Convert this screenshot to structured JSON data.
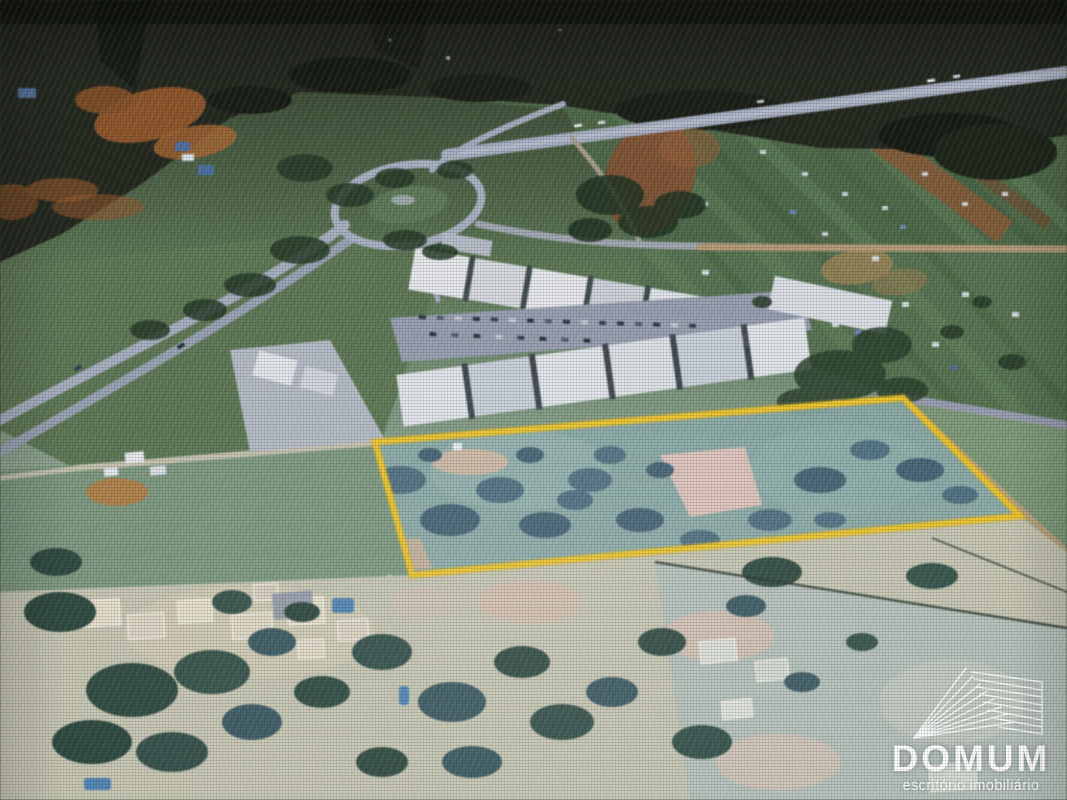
{
  "photo": {
    "description": "aerial satellite photo of a land parcel beside a highway roundabout and commercial strip",
    "annotation": {
      "parcel_points": "375,442 903,398 1020,516 412,575",
      "outline_color": "#f2c51e"
    }
  },
  "watermark": {
    "title": "DOMUM",
    "subtitle": "escritório imobiliário",
    "mark_icon": "domum-hatched-pyramid-icon",
    "text_color": "#ffffff"
  },
  "palette": {
    "dark_top": "#23271d",
    "field_green": "#567450",
    "bare_soil_orange": "#9a5c2b",
    "road_gray": "#a8b0c4",
    "road_tan": "#b99b76",
    "building_white": "#e8eaee",
    "parcel_teal": "#8aadaa",
    "cleared_pink": "#e0c3bd",
    "residential_cream": "#d3cbb6",
    "pool_blue": "#4d86b8",
    "tree_dark": "#243b26"
  }
}
